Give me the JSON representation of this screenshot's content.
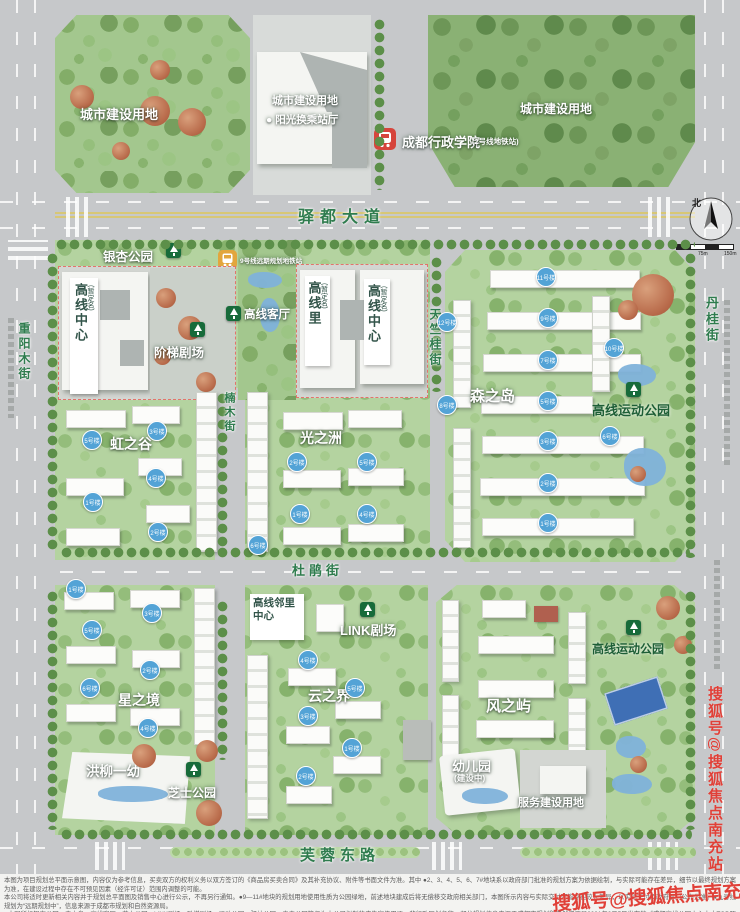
{
  "compass": {
    "north": "北",
    "scale": [
      "0",
      "75m",
      "150m"
    ]
  },
  "roads": {
    "yidu": "驿都大道",
    "dujuan": "杜鹃街",
    "furong": "芙蓉东路",
    "chongyangmu": "重阳木街",
    "nanmu": "楠木街",
    "tianzhugui": "天竺桂街",
    "dangui": "丹桂街"
  },
  "top": {
    "left_parcel": "城市建设用地",
    "mid_parcel": "城市建设用地",
    "mid_sub": "● 阳光换乘站厅",
    "right_parcel": "城市建设用地",
    "metro_name": "成都行政学院",
    "metro_note": "(2号线地铁站)",
    "planned_metro": "9号线远期规划地铁站"
  },
  "areas": {
    "yinxing_park": "银杏公园",
    "center_w_main": "高线中心",
    "center_w_sub": "(暂定名)",
    "jieti_theater": "阶梯剧场",
    "keting": "高线客厅",
    "li_main": "高线里",
    "li_sub": "(暂定名)",
    "center_e_main": "高线中心",
    "center_e_sub": "(暂定名)",
    "senzhidao": "森之岛",
    "sports_park_n": "高线运动公园",
    "hongzhigu": "虹之谷",
    "guangzhizhou": "光之洲",
    "neighborhood": "高线邻里中心",
    "link_theater": "LINK剧场",
    "xingzhijing": "星之境",
    "yunzhijie": "云之界",
    "fengzhiyu": "风之屿",
    "sports_park_s": "高线运动公园",
    "hongliu": "洪柳一幼",
    "cheese_park": "芝士公园",
    "kg_main": "幼儿园",
    "kg_sub": "(建设中)",
    "service_land": "服务建设用地"
  },
  "badges": {
    "sen": [
      {
        "label": "12号楼",
        "x": 447,
        "y": 322
      },
      {
        "label": "8号楼",
        "x": 447,
        "y": 405
      },
      {
        "label": "11号楼",
        "x": 546,
        "y": 277
      },
      {
        "label": "9号楼",
        "x": 548,
        "y": 318
      },
      {
        "label": "10号楼",
        "x": 614,
        "y": 348
      },
      {
        "label": "7号楼",
        "x": 548,
        "y": 360
      },
      {
        "label": "5号楼",
        "x": 548,
        "y": 401
      },
      {
        "label": "6号楼",
        "x": 610,
        "y": 436
      },
      {
        "label": "3号楼",
        "x": 548,
        "y": 441
      },
      {
        "label": "2号楼",
        "x": 548,
        "y": 483
      },
      {
        "label": "1号楼",
        "x": 548,
        "y": 523
      }
    ],
    "hong": [
      {
        "label": "5号楼",
        "x": 92,
        "y": 440
      },
      {
        "label": "3号楼",
        "x": 157,
        "y": 431
      },
      {
        "label": "4号楼",
        "x": 156,
        "y": 478
      },
      {
        "label": "1号楼",
        "x": 93,
        "y": 502
      },
      {
        "label": "2号楼",
        "x": 158,
        "y": 532
      }
    ],
    "guang": [
      {
        "label": "2号楼",
        "x": 297,
        "y": 462
      },
      {
        "label": "5号楼",
        "x": 367,
        "y": 462
      },
      {
        "label": "1号楼",
        "x": 300,
        "y": 514
      },
      {
        "label": "4号楼",
        "x": 367,
        "y": 514
      },
      {
        "label": "6号楼",
        "x": 258,
        "y": 545
      }
    ],
    "xing": [
      {
        "label": "1号楼",
        "x": 76,
        "y": 589
      },
      {
        "label": "3号楼",
        "x": 152,
        "y": 613
      },
      {
        "label": "5号楼",
        "x": 92,
        "y": 630
      },
      {
        "label": "2号楼",
        "x": 150,
        "y": 670
      },
      {
        "label": "6号楼",
        "x": 90,
        "y": 688
      },
      {
        "label": "4号楼",
        "x": 148,
        "y": 728
      }
    ],
    "yun": [
      {
        "label": "4号楼",
        "x": 308,
        "y": 660
      },
      {
        "label": "5号楼",
        "x": 355,
        "y": 688
      },
      {
        "label": "3号楼",
        "x": 308,
        "y": 716
      },
      {
        "label": "1号楼",
        "x": 352,
        "y": 748
      },
      {
        "label": "2号楼",
        "x": 306,
        "y": 776
      }
    ]
  },
  "watermark": {
    "side": "搜狐号@搜狐焦点南充站",
    "bottom": "搜狐号@搜狐焦点南充站"
  },
  "disclaimer": {
    "lines": [
      "本图为项目规划总平面示意图，内容仅为参考信息，买卖双方的权利义务以双方签订的《商品房买卖合同》及其补充协议、附件等书面文件为准。其中 ●2、3、4、5、6、7#地块系以政府部门批准的规划方案为依据绘制，与实际可能存在差异，细节以最终规划方案为准，在建设过程中存在不可预见因素（经许可证）范围内调整的可能。",
      "本公司将适时更新相关内容并于规划总平面图及销售中心进行公示，不再另行通知。●9—11#地块的规划用地使用性质为公园绿地，前述地块建成后将无偿移交政府相关部门，本图所示内容与实际交付可能存在较大差异，以实际交付及政府部门公布为准。●九号线规划为“远期规划中”，信息来源于成都市规划和自然资源局。",
      "●本图所标银杏公园、森之岛、高线客厅、芝士公园、LINK剧场、阶梯剧场、运动公园、驿站公园、春森公园等仅为本公司拟制的广告宣传用语，非行政区划名称；部分规划信息来源于成都市规划和自然资源局2021年2月5日发布的《成都高线公园中心十大TOD项目一体化城市设计》，规划内容以政府最终批复为准。",
      "●5#地块7号楼层高编号仅为101-2层，与3层层高编号存在较大差异。●代理机构为城家房地产经纪有限公司成都分公司、成都正合地产顾问股份有限公司、成都天恒美房地产营销策划有限公司。商品房预售证：5101122022062120、5101122022064422、5101122022064423。本资料制作时间详见资料扉页，敬请留意最新发布信息。"
    ]
  }
}
